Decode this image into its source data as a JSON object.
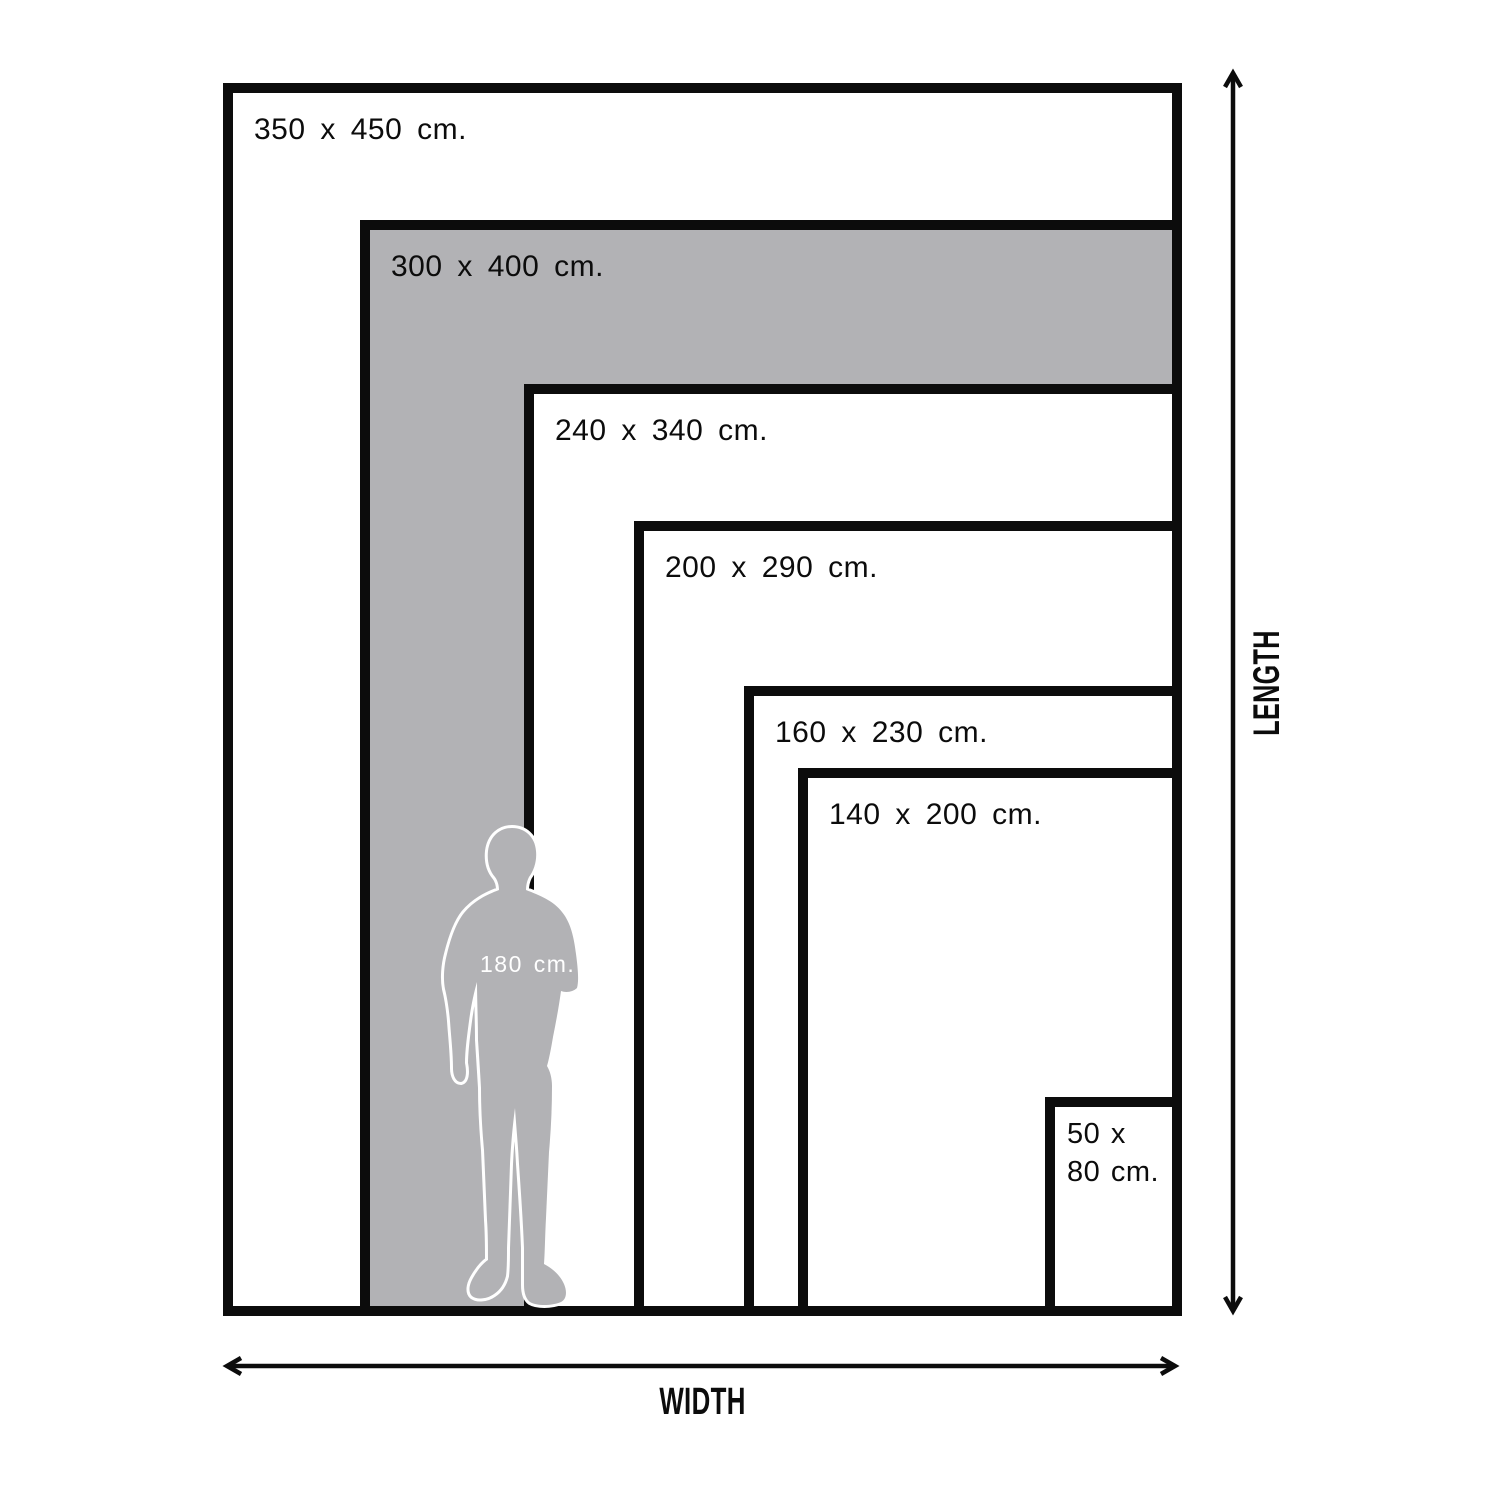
{
  "diagram": {
    "sizes": [
      {
        "label": "350 x 450 cm.",
        "width_cm": 350,
        "height_cm": 450,
        "highlighted": false
      },
      {
        "label": "300 x 400 cm.",
        "width_cm": 300,
        "height_cm": 400,
        "highlighted": true
      },
      {
        "label": "240 x 340 cm.",
        "width_cm": 240,
        "height_cm": 340,
        "highlighted": false
      },
      {
        "label": "200 x 290 cm.",
        "width_cm": 200,
        "height_cm": 290,
        "highlighted": false
      },
      {
        "label": "160 x 230 cm.",
        "width_cm": 160,
        "height_cm": 230,
        "highlighted": false
      },
      {
        "label": "140 x 200 cm.",
        "width_cm": 140,
        "height_cm": 200,
        "highlighted": false
      },
      {
        "label": "50 x 80 cm.",
        "width_cm": 50,
        "height_cm": 80,
        "highlighted": false
      }
    ],
    "person": {
      "label": "180 cm.",
      "height_cm": 180
    },
    "axes": {
      "width_label": "WIDTH",
      "length_label": "LENGTH"
    },
    "colors": {
      "ink": "#0c0c0c",
      "highlight_gray": "#b2b2b5",
      "background": "#ffffff",
      "person_label_text": "#ffffff"
    }
  }
}
